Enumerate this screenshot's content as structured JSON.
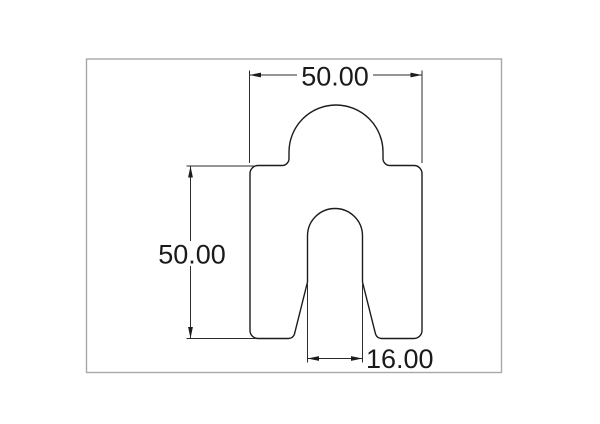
{
  "drawing": {
    "colors": {
      "outline": "#1c1c1c",
      "dimension": "#2b2b2b",
      "frame": "#a8a8a8",
      "text": "#1a1a1a",
      "background": "#ffffff"
    },
    "dimensions": {
      "width_top": {
        "label": "50.00",
        "value": 50.0
      },
      "height_left": {
        "label": "50.00",
        "value": 50.0
      },
      "slot_width_bottom": {
        "label": "16.00",
        "value": 16.0
      }
    }
  }
}
